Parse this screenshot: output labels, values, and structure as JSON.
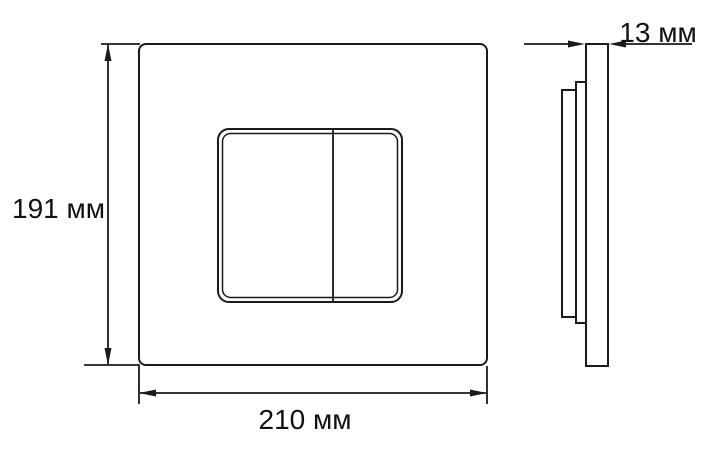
{
  "drawing": {
    "labels": {
      "height": "191 мм",
      "width": "210 мм",
      "depth": "13 мм"
    },
    "dimensions_mm": {
      "height": 191,
      "width": 210,
      "depth": 13
    },
    "unit": "мм",
    "colors": {
      "line": "#1a1a1a",
      "text": "#111111",
      "background": "#ffffff"
    }
  }
}
